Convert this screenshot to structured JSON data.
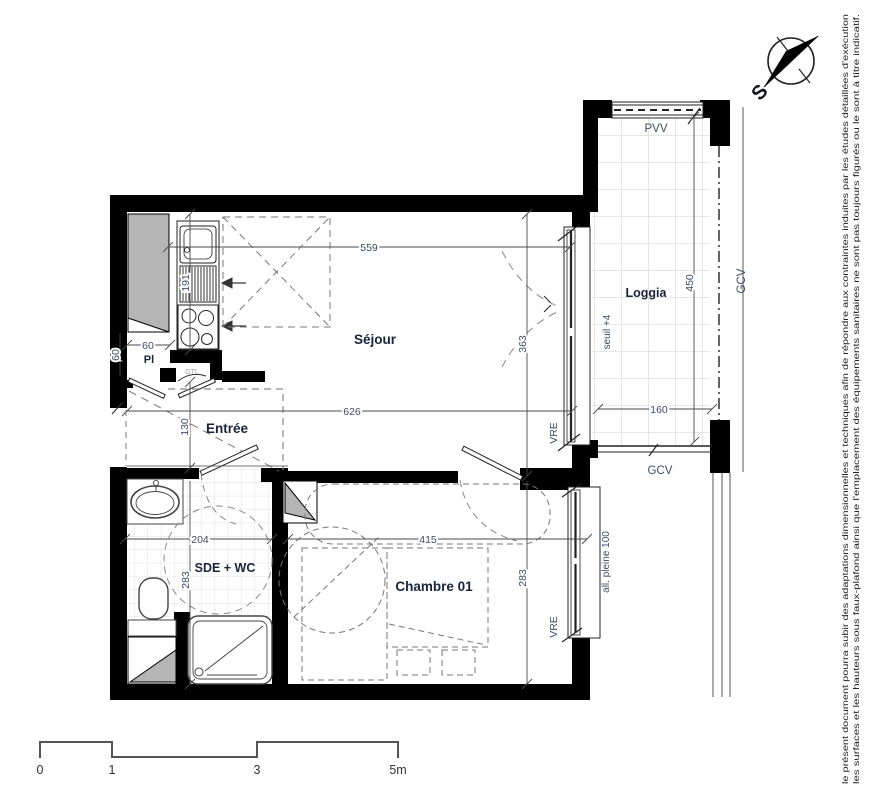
{
  "labels": {
    "sejour": "Séjour",
    "loggia": "Loggia",
    "entree": "Entrée",
    "sde_wc": "SDE + WC",
    "chambre": "Chambre 01",
    "placard": "Pl",
    "gtl": "GTL",
    "pvv": "PVV",
    "gcv_bottom": "GCV",
    "gcv_right": "GCV",
    "vre_sejour": "VRE",
    "vre_chambre": "VRE",
    "seuil": "seuil +4",
    "allege": "all. pleine 100",
    "compass_s": "S"
  },
  "dims": {
    "d559": "559",
    "d626": "626",
    "d363": "363",
    "d450": "450",
    "d160": "160",
    "d191": "191",
    "d130": "130",
    "d60a": "60",
    "d60b": "60",
    "d204": "204",
    "d283_sde": "283",
    "d415": "415",
    "d283_ch": "283"
  },
  "scale": {
    "t0": "0",
    "t1": "1",
    "t2": "3",
    "t3": "5m"
  },
  "disclaimer": {
    "line1": "le présent document pourra subir des adaptations dimensionnelles et techniques afin de répondre aux contraintes induites par les études détaillées d'exécution",
    "line2": "les surfaces et les hauteurs sous faux-plafond ainsi que l'emplacement des équipements sanitaires ne sont pas toujours figurés ou le sont à titre indicatif."
  },
  "colors": {
    "wall": "#000000",
    "line": "#333333",
    "dim": "#4a4a4a",
    "tile": "#cccccc",
    "duct": "#b5b5b5"
  }
}
